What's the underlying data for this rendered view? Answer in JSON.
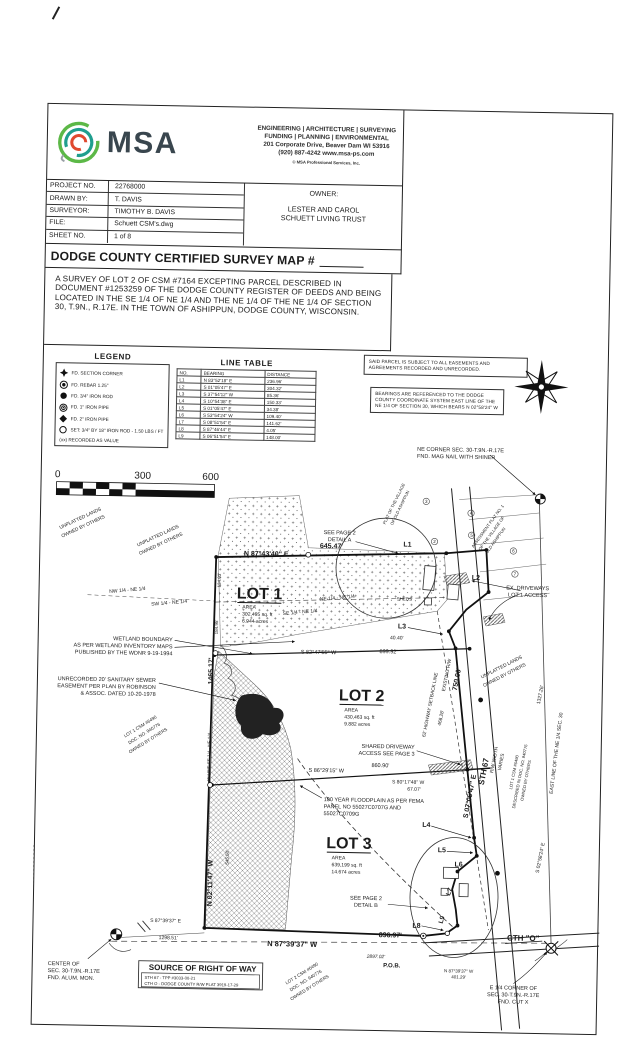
{
  "header": {
    "logo_text": "MSA",
    "services_line1": "ENGINEERING | ARCHITECTURE | SURVEYING",
    "services_line2": "FUNDING | PLANNING | ENVIRONMENTAL",
    "address": "201 Corporate Drive, Beaver Dam WI 53916",
    "phone_web": "(920) 887-4242      www.msa-ps.com",
    "copyright": "© MSA Professional Services, Inc.",
    "info_rows": [
      {
        "label": "PROJECT NO.",
        "value": "22768000"
      },
      {
        "label": "DRAWN BY:",
        "value": "T. DAVIS"
      },
      {
        "label": "SURVEYOR:",
        "value": "TIMOTHY B. DAVIS"
      },
      {
        "label": "FILE:",
        "value": "Schuett CSM's.dwg"
      },
      {
        "label": "SHEET NO.",
        "value": "1 of 8"
      }
    ],
    "owner_label": "OWNER:",
    "owner_line1": "LESTER AND CAROL",
    "owner_line2": "SCHUETT LIVING TRUST"
  },
  "title": "DODGE COUNTY CERTIFIED SURVEY MAP #",
  "description": "A SURVEY OF LOT 2 OF CSM #7164 EXCEPTING PARCEL DESCRIBED IN DOCUMENT #1253259 OF THE DODGE COUNTY REGISTER OF DEEDS AND BEING LOCATED IN THE SE 1/4 OF NE 1/4 AND THE NE 1/4 OF THE NE 1/4 OF SECTION 30, T.9N., R.17E. IN THE TOWN OF ASHIPPUN, DODGE COUNTY, WISCONSIN.",
  "legend": {
    "title": "LEGEND",
    "items": [
      {
        "symbol": "section-corner",
        "label": "FD. SECTION CORNER"
      },
      {
        "symbol": "rebar",
        "label": "FD. REBAR 1.25\""
      },
      {
        "symbol": "iron-rod",
        "label": "FD. 3/4\" IRON ROD"
      },
      {
        "symbol": "iron-pipe-1",
        "label": "FD. 1\" IRON PIPE"
      },
      {
        "symbol": "iron-pipe-2",
        "label": "FD. 2\" IRON PIPE"
      },
      {
        "symbol": "set-rod",
        "label": "SET: 3/4\" BY 18\" IRON ROD - 1.50 LBS / FT"
      }
    ],
    "footnote": "(xx) RECORDED AS VALUE"
  },
  "line_table": {
    "title": "LINE TABLE",
    "headers": [
      "NO.",
      "BEARING",
      "DISTANCE"
    ],
    "rows": [
      [
        "L1",
        "N 83°52'18\" E",
        "236.96'"
      ],
      [
        "L2",
        "S 01°05'47\" E",
        "304.32'"
      ],
      [
        "L3",
        "S 37°54'12\" W",
        "85.36'"
      ],
      [
        "L4",
        "S 10°54'38\" E",
        "150.33'"
      ],
      [
        "L5",
        "S 01°05'47\" E",
        "34.38'"
      ],
      [
        "L6",
        "S 53°54'24\" W",
        "109.40'"
      ],
      [
        "L7",
        "S 08°51'54\" E",
        "141.62'"
      ],
      [
        "L8",
        "S 87°46'44\" E",
        "4.05'"
      ],
      [
        "L9",
        "S 06°51'54\" E",
        "148.00'"
      ]
    ]
  },
  "notes": {
    "note1": "SAID PARCEL IS SUBJECT TO ALL EASEMENTS AND AGREEMENTS RECORDED AND UNRECORDED.",
    "note2": "BEARINGS ARE REFERENCED TO THE DODGE COUNTY COORDINATE SYSTEM EAST LINE OF THE NE 1/4 OF SECTION 30, WHICH BEARS N 02°58'24\" W"
  },
  "scale_bar": {
    "start": "0",
    "mid": "300",
    "end": "600"
  },
  "colors": {
    "ink": "#1b1b1b",
    "logo_green": "#5cb847",
    "logo_teal": "#1f9e8e",
    "logo_red": "#e0492f",
    "logo_slate": "#39464e"
  },
  "map": {
    "labels": [
      {
        "t": "0",
        "x": 58,
        "y": 485,
        "s": 10
      },
      {
        "t": "300",
        "x": 143,
        "y": 485,
        "s": 10
      },
      {
        "t": "600",
        "x": 211,
        "y": 485,
        "s": 10
      },
      {
        "t": "NE CORNER SEC. 30-T.9N.-R.17E",
        "x": 417,
        "y": 452,
        "s": 5.5,
        "a": "start"
      },
      {
        "t": "FND. MAG NAIL WITH SHINER",
        "x": 417,
        "y": 459,
        "s": 5.5,
        "a": "start"
      },
      {
        "t": "SEE PAGE 2",
        "x": 341,
        "y": 537,
        "s": 5.5
      },
      {
        "t": "DETAIL A",
        "x": 341,
        "y": 544,
        "s": 5.5
      },
      {
        "t": "645.47'",
        "x": 333,
        "y": 551,
        "s": 7,
        "b": 1
      },
      {
        "t": "N 87°43'40\" E",
        "x": 268,
        "y": 560,
        "s": 7,
        "b": 1
      },
      {
        "t": "L1",
        "x": 409,
        "y": 548,
        "s": 7,
        "b": 1
      },
      {
        "t": "L2",
        "x": 478,
        "y": 580,
        "s": 7,
        "b": 1
      },
      {
        "t": "L3",
        "x": 405,
        "y": 630,
        "s": 7,
        "b": 1
      },
      {
        "t": "SHEDS",
        "x": 407,
        "y": 602,
        "s": 4.5
      },
      {
        "t": "EX. DRIVEWAYS",
        "x": 530,
        "y": 589,
        "s": 5.5
      },
      {
        "t": "LOT 1 ACCESS",
        "x": 530,
        "y": 596,
        "s": 5.5
      },
      {
        "t": "NE 1/4 - NE 1/4",
        "x": 340,
        "y": 602,
        "s": 5,
        "r": -6
      },
      {
        "t": "SE 1/4 - NE 1/4",
        "x": 303,
        "y": 617,
        "s": 5,
        "r": -6
      },
      {
        "t": "NW 1/4 - NE 1/4",
        "x": 130,
        "y": 598,
        "s": 5,
        "r": -6
      },
      {
        "t": "SW 1/4 - NE 1/4",
        "x": 172,
        "y": 610,
        "s": 5,
        "r": -6
      },
      {
        "t": "LOT 1",
        "x": 262,
        "y": 603,
        "s": 16,
        "b": 1
      },
      {
        "t": "AREA",
        "x": 245,
        "y": 613,
        "s": 5,
        "a": "start"
      },
      {
        "t": "302,495 sq. ft",
        "x": 245,
        "y": 620,
        "s": 5,
        "a": "start"
      },
      {
        "t": "6.944 acres",
        "x": 245,
        "y": 627,
        "s": 5,
        "a": "start"
      },
      {
        "t": "134.03'",
        "x": 223,
        "y": 585,
        "s": 4.5,
        "r": -90
      },
      {
        "t": "184.95'",
        "x": 221,
        "y": 632,
        "s": 4.5,
        "r": -90
      },
      {
        "t": "UNPLATTED LANDS",
        "x": 160,
        "y": 543,
        "s": 4.8,
        "r": -26
      },
      {
        "t": "OWNED BY OTHERS",
        "x": 163,
        "y": 551,
        "s": 4.8,
        "r": -26
      },
      {
        "t": "UNPLATTED LANDS",
        "x": 82,
        "y": 527,
        "s": 4.8,
        "r": -26
      },
      {
        "t": "OWNED BY OTHERS",
        "x": 85,
        "y": 535,
        "s": 4.8,
        "r": -26
      },
      {
        "t": "WETLAND BOUNDARY",
        "x": 176,
        "y": 647,
        "s": 5.5,
        "a": "end"
      },
      {
        "t": "AS PER WETLAND INVENTORY MAPS",
        "x": 176,
        "y": 654,
        "s": 5.5,
        "a": "end"
      },
      {
        "t": "PUBLISHED BY THE WDNR 9-19-1994",
        "x": 176,
        "y": 661,
        "s": 5.5,
        "a": "end"
      },
      {
        "t": "1465.17'",
        "x": 217,
        "y": 676,
        "s": 7,
        "b": 1,
        "r": -90
      },
      {
        "t": "UNRECORDED 20' SANITARY SEWER",
        "x": 160,
        "y": 688,
        "s": 5.5,
        "a": "end"
      },
      {
        "t": "EASEMENT PER PLAN BY ROBINSON",
        "x": 160,
        "y": 695,
        "s": 5.5,
        "a": "end"
      },
      {
        "t": "& ASSOC. DATED 10-20-1978",
        "x": 160,
        "y": 702,
        "s": 5.5,
        "a": "end"
      },
      {
        "t": "LOT 1 CSM #6490",
        "x": 146,
        "y": 734,
        "s": 4.5,
        "r": -33
      },
      {
        "t": "DOC. NO. 940776",
        "x": 150,
        "y": 741,
        "s": 4.5,
        "r": -33
      },
      {
        "t": "OWNED BY OTHERS",
        "x": 154,
        "y": 748,
        "s": 4.5,
        "r": -33
      },
      {
        "t": "W LINE SE 1/4 - NE 1/4",
        "x": 216,
        "y": 762,
        "s": 4.5,
        "r": -90
      },
      {
        "t": "S 82°47'55\" W",
        "x": 322,
        "y": 657,
        "s": 5.5
      },
      {
        "t": "899.92'",
        "x": 392,
        "y": 655,
        "s": 5.5
      },
      {
        "t": "40.40'",
        "x": 400,
        "y": 641,
        "s": 5
      },
      {
        "t": "LOT 2",
        "x": 366,
        "y": 703,
        "s": 16,
        "b": 1
      },
      {
        "t": "AREA",
        "x": 349,
        "y": 714,
        "s": 5,
        "a": "start"
      },
      {
        "t": "430,463 sq. ft",
        "x": 349,
        "y": 721,
        "s": 5,
        "a": "start"
      },
      {
        "t": "9.882 acres",
        "x": 349,
        "y": 728,
        "s": 5,
        "a": "start"
      },
      {
        "t": "62' HIGHWAY SETBACK LINE",
        "x": 436,
        "y": 706,
        "s": 4.8,
        "r": -80
      },
      {
        "t": "EXISTING R/W",
        "x": 452,
        "y": 676,
        "s": 4.8,
        "r": -80
      },
      {
        "t": "750.00'",
        "x": 463,
        "y": 680,
        "s": 7,
        "b": 1,
        "r": -80
      },
      {
        "t": "468.28'",
        "x": 447,
        "y": 719,
        "s": 4.8,
        "r": -80
      },
      {
        "t": "STH 67",
        "x": 492,
        "y": 772,
        "s": 8,
        "b": 1,
        "r": -80
      },
      {
        "t": "S 07°05'47\" E",
        "x": 478,
        "y": 797,
        "s": 7,
        "b": 1,
        "r": -80
      },
      {
        "t": "R/W WIDTH",
        "x": 501,
        "y": 760,
        "s": 4.8,
        "r": -80
      },
      {
        "t": "VARIES",
        "x": 508,
        "y": 762,
        "s": 4.8,
        "r": -80
      },
      {
        "t": "1327.26'",
        "x": 546,
        "y": 694,
        "s": 5,
        "r": -80
      },
      {
        "t": "UNPLATTED LANDS",
        "x": 506,
        "y": 668,
        "s": 4.8,
        "r": -28
      },
      {
        "t": "OWNED BY OTHERS",
        "x": 509,
        "y": 676,
        "s": 4.8,
        "r": -28
      },
      {
        "t": "LOT 1 CSM #6490",
        "x": 521,
        "y": 772,
        "s": 4.2,
        "r": -80
      },
      {
        "t": "DESCRIBED IN DOC. NO. 940776",
        "x": 527,
        "y": 776,
        "s": 4.2,
        "r": -80
      },
      {
        "t": "OWNED BY OTHERS",
        "x": 533,
        "y": 780,
        "s": 4.2,
        "r": -80
      },
      {
        "t": "EAST LINE OF THE NE 1/4 SEC. 30",
        "x": 563,
        "y": 752,
        "s": 5,
        "r": -84
      },
      {
        "t": "S 02°58'24\" E",
        "x": 549,
        "y": 857,
        "s": 5,
        "r": -80
      },
      {
        "t": "SHARED DRIVEWAY",
        "x": 420,
        "y": 750,
        "s": 5.5,
        "a": "end"
      },
      {
        "t": "ACCESS SEE PAGE 3",
        "x": 420,
        "y": 757,
        "s": 5.5,
        "a": "end"
      },
      {
        "t": "S 86°29'15\" W",
        "x": 332,
        "y": 775,
        "s": 5.5
      },
      {
        "t": "860.90'",
        "x": 386,
        "y": 769,
        "s": 5.5
      },
      {
        "t": "S 80°17'48\" W",
        "x": 414,
        "y": 785,
        "s": 5
      },
      {
        "t": "67.07'",
        "x": 420,
        "y": 792,
        "s": 5
      },
      {
        "t": "100 YEAR FLOODPLAIN AS PER FEMA",
        "x": 330,
        "y": 804,
        "s": 5.5,
        "a": "start"
      },
      {
        "t": "PANEL NO 55027C0707G AND",
        "x": 330,
        "y": 811,
        "s": 5.5,
        "a": "start"
      },
      {
        "t": "55027C0709G",
        "x": 330,
        "y": 818,
        "s": 5.5,
        "a": "start"
      },
      {
        "t": "LOT 3",
        "x": 356,
        "y": 851,
        "s": 16,
        "b": 1
      },
      {
        "t": "AREA",
        "x": 339,
        "y": 862,
        "s": 5,
        "a": "start"
      },
      {
        "t": "639,199 sq. ft",
        "x": 339,
        "y": 869,
        "s": 5,
        "a": "start"
      },
      {
        "t": "14.674 acres",
        "x": 339,
        "y": 876,
        "s": 5,
        "a": "start"
      },
      {
        "t": "L4",
        "x": 433,
        "y": 828,
        "s": 7,
        "b": 1
      },
      {
        "t": "L5",
        "x": 449,
        "y": 853,
        "s": 7,
        "b": 1
      },
      {
        "t": "L6",
        "x": 466,
        "y": 867,
        "s": 7,
        "b": 1
      },
      {
        "t": "L7",
        "x": 459,
        "y": 893,
        "s": 6.5,
        "b": 1,
        "r": -70
      },
      {
        "t": "L8",
        "x": 425,
        "y": 929,
        "s": 7,
        "b": 1
      },
      {
        "t": "L9",
        "x": 452,
        "y": 921,
        "s": 6.5,
        "b": 1,
        "r": -75
      },
      {
        "t": "SEE PAGE 2",
        "x": 374,
        "y": 902,
        "s": 5.5
      },
      {
        "t": "DETAIL B",
        "x": 374,
        "y": 909,
        "s": 5.5
      },
      {
        "t": "896.97'",
        "x": 399,
        "y": 939,
        "s": 7,
        "b": 1
      },
      {
        "t": "N 87°39'37\" W",
        "x": 301,
        "y": 950,
        "s": 7.5,
        "b": 1
      },
      {
        "t": "2897.02'",
        "x": 385,
        "y": 960,
        "s": 4.8,
        "i": 1
      },
      {
        "t": "P.O.B.",
        "x": 401,
        "y": 969,
        "s": 6,
        "b": 1
      },
      {
        "t": "N 87°39'37\" W",
        "x": 468,
        "y": 973,
        "s": 4.5
      },
      {
        "t": "401.29'",
        "x": 468,
        "y": 979,
        "s": 4.5
      },
      {
        "t": "CTH \"O\"",
        "x": 532,
        "y": 940,
        "s": 8,
        "b": 1
      },
      {
        "t": "E 1/4 CORNER OF",
        "x": 523,
        "y": 989,
        "s": 5.5
      },
      {
        "t": "SEC. 30-T.9N.-R.17E",
        "x": 523,
        "y": 996,
        "s": 5.5
      },
      {
        "t": "FND. CUT X",
        "x": 523,
        "y": 1003,
        "s": 5.5
      },
      {
        "t": "S 87°39'37\" E",
        "x": 174,
        "y": 928,
        "s": 5
      },
      {
        "t": "1298.51'",
        "x": 177,
        "y": 945,
        "s": 5
      },
      {
        "t": "N 02°11'47\" W",
        "x": 220,
        "y": 888,
        "s": 7,
        "b": 1,
        "r": -90
      },
      {
        "t": "545.50'",
        "x": 236,
        "y": 862,
        "s": 4.5,
        "r": -90
      },
      {
        "t": "CENTER OF",
        "x": 57,
        "y": 973,
        "s": 5.5,
        "a": "start"
      },
      {
        "t": "SEC. 30-T.9N.-R.17E",
        "x": 57,
        "y": 980,
        "s": 5.5,
        "a": "start"
      },
      {
        "t": "FND. ALUM. MON.",
        "x": 57,
        "y": 987,
        "s": 5.5,
        "a": "start"
      },
      {
        "t": "SOURCE OF RIGHT OF WAY",
        "x": 212,
        "y": 976,
        "s": 8,
        "b": 1
      },
      {
        "t": "STH 67 - TPP #3033-00-21",
        "x": 154,
        "y": 985,
        "s": 4.2,
        "a": "start"
      },
      {
        "t": "CTH O - DODGE COUNTY R/W PLAT 3919-17-29",
        "x": 154,
        "y": 991,
        "s": 4.2,
        "a": "start"
      },
      {
        "t": "LOT 2 CSM #6490",
        "x": 312,
        "y": 978,
        "s": 4.5,
        "r": -33
      },
      {
        "t": "DOC. NO. 940776",
        "x": 316,
        "y": 985,
        "s": 4.5,
        "r": -33
      },
      {
        "t": "OWNED BY OTHERS",
        "x": 320,
        "y": 992,
        "s": 4.5,
        "r": -33
      },
      {
        "t": "ASSESSMENT PLAT NO. 1",
        "x": 490,
        "y": 527,
        "s": 4.2,
        "r": -55
      },
      {
        "t": "OF THE VILLAGE OF",
        "x": 494,
        "y": 534,
        "s": 4.2,
        "r": -55
      },
      {
        "t": "OLD ASHIPPUN",
        "x": 498,
        "y": 541,
        "s": 4.2,
        "r": -55
      },
      {
        "t": "PLAT OF THE VILLAGE",
        "x": 396,
        "y": 506,
        "s": 4.2,
        "r": -65
      },
      {
        "t": "OF OLD ASHIPPUN",
        "x": 402,
        "y": 510,
        "s": 4.2,
        "r": -65
      },
      {
        "t": "3",
        "x": 427,
        "y": 504,
        "s": 4.5
      },
      {
        "t": "2",
        "x": 436,
        "y": 544,
        "s": 4.5
      },
      {
        "t": "4",
        "x": 472,
        "y": 515,
        "s": 4.5
      },
      {
        "t": "5",
        "x": 473,
        "y": 537,
        "s": 4.5
      },
      {
        "t": "6",
        "x": 515,
        "y": 552,
        "s": 4.5
      },
      {
        "t": "7",
        "x": 517,
        "y": 575,
        "s": 4.5
      }
    ]
  }
}
